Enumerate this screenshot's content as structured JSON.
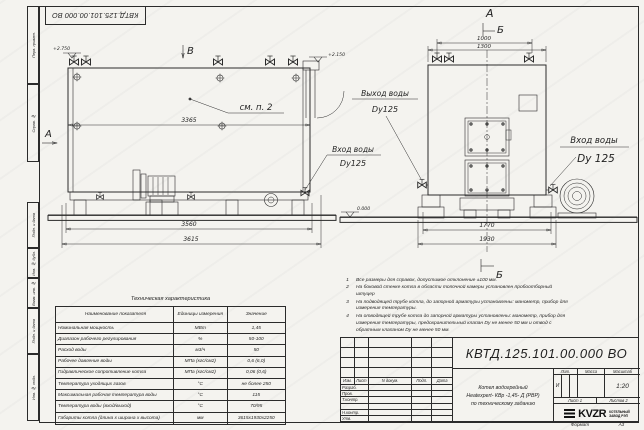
{
  "colors": {
    "line": "#2b2b2b",
    "paper": "#f4f3ef"
  },
  "stamp_top": {
    "doc_number": "КВТД.125.101.00.000 ВО"
  },
  "frame_fields": [
    "Перв. примен.",
    "Справ. №",
    "Подп. и дата",
    "Инв. № дубл.",
    "Взам. инв. №",
    "Подп. и дата",
    "Инв. № подл."
  ],
  "drawing": {
    "side": {
      "elev_top": "+2.750",
      "marker_v": "В",
      "marker_a": "А",
      "callout": "см. п. 2",
      "dim_inner": "3365",
      "dim_base": "3560",
      "dim_overall": "3615",
      "inlet_line1": "Вход воды",
      "inlet_line2": "Dy125",
      "elev_ground": "0.000",
      "elev_mid": "+2.150"
    },
    "front": {
      "marker_a": "А",
      "marker_b_top": "Б",
      "marker_b_bottom": "Б",
      "dim_top_inner": "1000",
      "dim_top_outer": "1300",
      "dim_bottom_inner": "1770",
      "dim_bottom_outer": "1930",
      "outlet_line1": "Выход воды",
      "outlet_line2": "Dy125",
      "inlet_line1": "Вход воды",
      "inlet_line2": "Dy 125"
    }
  },
  "tech_table": {
    "title": "Техническая характеристика",
    "headers": [
      "Наименование показателя",
      "Единицы измерения",
      "Значение"
    ],
    "rows": [
      [
        "Номинальная мощность",
        "МВт",
        "1,45"
      ],
      [
        "Диапазон рабочего регулирования",
        "%",
        "50-100"
      ],
      [
        "Расход воды",
        "м3/ч",
        "50"
      ],
      [
        "Рабочее давление воды",
        "МПа (кгс/см2)",
        "0,6 (6,0)"
      ],
      [
        "Гидравлическое сопротивление котла",
        "МПа (кгс/см2)",
        "0,06 (0,6)"
      ],
      [
        "Температура уходящих газов",
        "°С",
        "не более 250"
      ],
      [
        "Максимальная рабочая температура воды",
        "°С",
        "115"
      ],
      [
        "Температура воды (вход/выход)",
        "°С",
        "70/95"
      ],
      [
        "Габариты котла (длина х ширина х высота)",
        "мм",
        "3615х1930х2250"
      ]
    ]
  },
  "notes": [
    {
      "n": "1",
      "t": "Все размеры для справок, допустимое отклонение ±100 мм."
    },
    {
      "n": "2",
      "t": "На боковой стенке котла в области топочной камеры установлен пробоотборный штуцер"
    },
    {
      "n": "3",
      "t": "На подводящей трубе котла, до запорной арматуры установлены: манометр, прибор для измерения температуры."
    },
    {
      "n": "4",
      "t": "На отводящей трубе котла до запорной арматуры установлены: манометр, прибор для измерения температуры, предохранительный клапан Dу не менее 50 мм и отвод с обратным клапаном Dу не менее 50 мм."
    }
  ],
  "title_block": {
    "doc_number": "КВТД.125.101.00.000 ВО",
    "header_cols": [
      "Изм.",
      "Лист",
      "N докум.",
      "Подп.",
      "Дата"
    ],
    "row_labels": [
      "Разраб.",
      "Пров.",
      "Т.контр.",
      "",
      "Н.контр.",
      "Утв."
    ],
    "name_line1": "Котел водогрейный",
    "name_line2": "Heatexpert- КВр -1,45- Д (РВР)",
    "name_line3": "по техническому заданию",
    "lit_header": [
      "Лит.",
      "Масса",
      "Масштаб"
    ],
    "lit_value": "И",
    "scale": "1:20",
    "sheet_label": "Лист 1",
    "sheets_label": "Листов 2",
    "logo_text": "KVZR",
    "logo_caption_1": "КОТЕЛЬНЫЙ",
    "logo_caption_2": "ЗАВОД РЭП",
    "format_label": "Формат",
    "format_value": "А3"
  }
}
